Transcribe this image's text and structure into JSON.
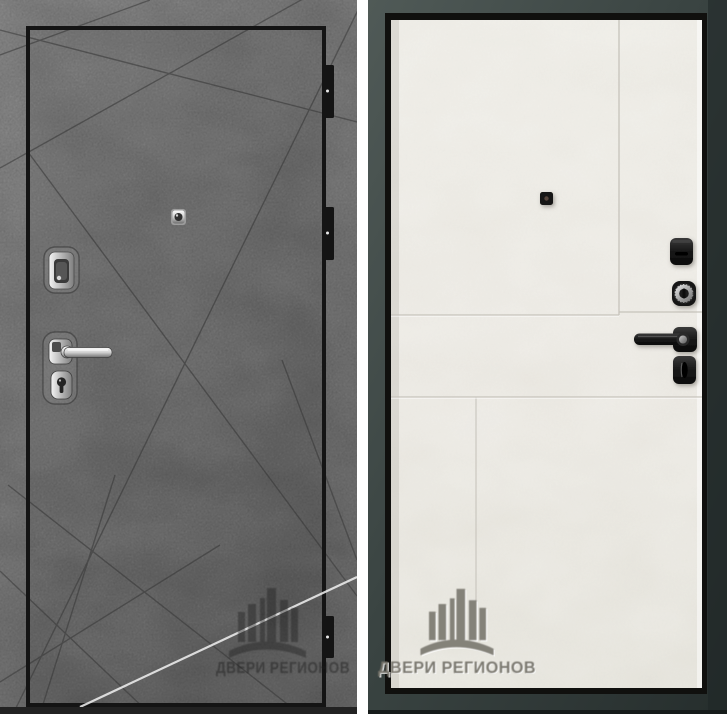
{
  "photo": {
    "subject": "steel-entrance-door-front-and-back",
    "background_color": "#ffffff"
  },
  "left_door": {
    "side": "exterior-concrete-panel",
    "watermark_text": "ДВЕРИ РЕГИОНОВ",
    "colors": {
      "concrete_base": "#757575",
      "concrete_dark": "#5d5d5d",
      "groove_lines": "#383838",
      "leaf_border": "#141414",
      "glare_line": "#f2f2f2",
      "chrome": "#d9d9d9",
      "hinge": "#141414"
    },
    "hardware": {
      "peephole": "peephole",
      "upper_lock": "lock-escutcheon",
      "handle": "chrome-lever-handle",
      "cylinder": "key-cylinder",
      "hinges_visible": 3
    }
  },
  "right_door": {
    "side": "interior-cream-panel",
    "watermark_text": "ДВЕРИ РЕГИОНОВ",
    "colors": {
      "frame": "#3a4442",
      "frame_edge": "#10100e",
      "panel": "#eae7e0",
      "seam_lines": "#c9c6be",
      "hardware_black": "#161616",
      "cylinder_chrome": "#c8c8c8"
    },
    "hardware": {
      "peephole": "peephole",
      "night_latch": "night-latch",
      "cylinder": "key-cylinder",
      "handle": "black-lever-handle",
      "thumbturn": "thumbturn"
    }
  }
}
